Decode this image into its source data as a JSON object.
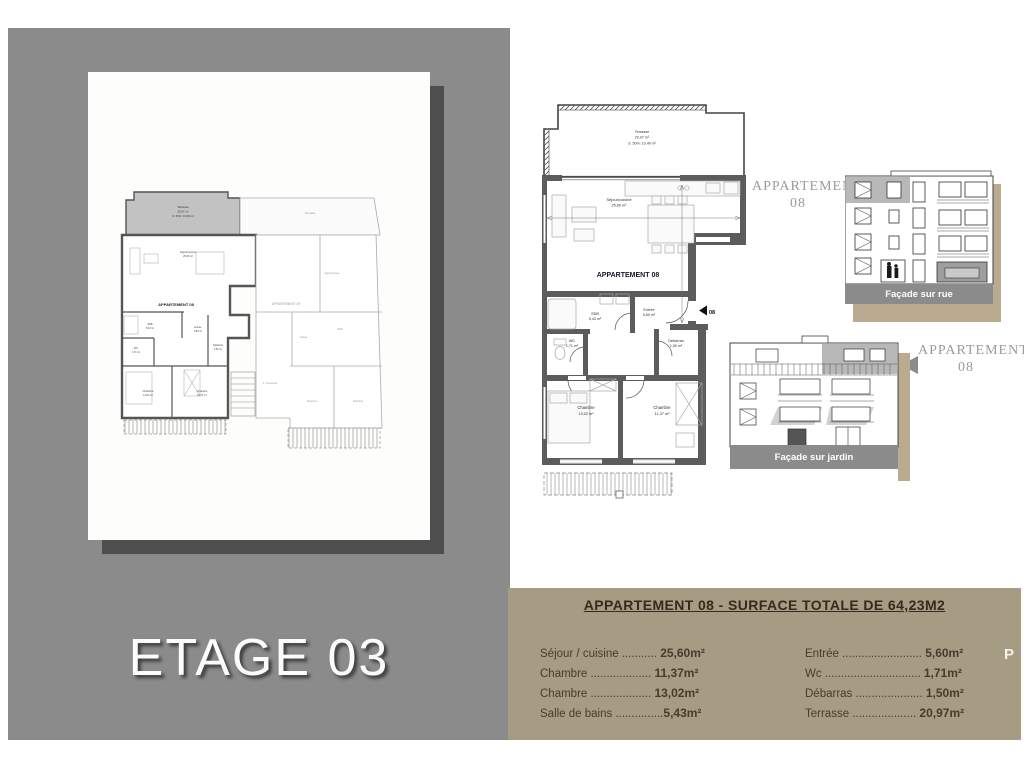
{
  "page": {
    "floor_label": "ETAGE 03",
    "cutoff_text": "P"
  },
  "colors": {
    "panel_gray": "#8b8b8b",
    "sheet_shadow": "#4e4e4e",
    "surface_box_tan": "#a69b83",
    "facade_shadow_tan": "#b9aa90",
    "wall_dark": "#5c5c5c",
    "wall_light": "#a5a5a5",
    "apartment_highlight_gray": "#c2c2c2",
    "caption_bar_gray": "#8b8b8b",
    "facade_label_gray": "#9b9b9b"
  },
  "apartment_plan": {
    "title": "APPARTEMENT 08",
    "door_label": "08",
    "terrace": [
      "Terrasse",
      "20,97 m²",
      "S. 50%: 10,49 m²"
    ],
    "rooms": {
      "sejour": [
        "Séjour/cuisine",
        "25,60 m²"
      ],
      "entree": [
        "Entrée",
        "5,60 m²"
      ],
      "sdb": [
        "SDB",
        "5,43 m²"
      ],
      "wc": [
        "WC",
        "1,71 m²"
      ],
      "debarras": [
        "Débarras",
        "1,50 m²"
      ],
      "chambre1": [
        "Chambre",
        "13,02 m²"
      ],
      "chambre2": [
        "Chambre",
        "11,37 m²"
      ]
    }
  },
  "floor_plan": {
    "apt08_label": "APPARTEMENT 08",
    "apt09_label": "APPARTEMENT 09",
    "terrace08": [
      "Terrasse",
      "20,97 m²",
      "S. 50%: 10,49 m²"
    ],
    "terrace09": "Terrasse",
    "apt08_rooms": {
      "sejour": [
        "Séjour/cuisine",
        "25,60 m²"
      ],
      "sdb": [
        "SDB",
        "5,43 m²"
      ],
      "wc": [
        "WC",
        "1,71 m²"
      ],
      "entree": [
        "Entrée",
        "5,60 m²"
      ],
      "debarras": [
        "Débarras",
        "1,50 m²"
      ],
      "chambre1": [
        "Chambre",
        "13,02 m²"
      ],
      "chambre2": [
        "Chambre",
        "11,37 m²"
      ]
    },
    "apt09_rooms": {
      "sejour": "Séjour/cuisine",
      "sdb": "SDB",
      "entree": "Entrée",
      "chambre1": "Chambre",
      "chambre2": "Chambre"
    },
    "common_label": "2. Poussettes"
  },
  "facades": {
    "street": {
      "label_line1": "APPARTEMENT",
      "label_line2": "08",
      "caption": "Façade sur rue"
    },
    "garden": {
      "label_line1": "APPARTEMENT",
      "label_line2": "08",
      "caption": "Façade sur jardin"
    }
  },
  "surface_table": {
    "title": "APPARTEMENT 08  -  SURFACE TOTALE DE 64,23M2",
    "left_rows": [
      {
        "label": "Séjour / cuisine",
        "dots": "...........",
        "value": "25,60m²"
      },
      {
        "label": "Chambre",
        "dots": "...................",
        "value": "11,37m²"
      },
      {
        "label": "Chambre",
        "dots": "...................",
        "value": "13,02m²"
      },
      {
        "label": "Salle de bains",
        "dots": "...............",
        "value": "5,43m²"
      }
    ],
    "right_rows": [
      {
        "label": "Entrée",
        "dots": ".........................",
        "value": "5,60m²"
      },
      {
        "label": "Wc",
        "dots": "..............................",
        "value": "1,71m²"
      },
      {
        "label": "Débarras",
        "dots": ".....................",
        "value": "1,50m²"
      },
      {
        "label": "Terrasse",
        "dots": "....................",
        "value": "20,97m²"
      }
    ]
  }
}
